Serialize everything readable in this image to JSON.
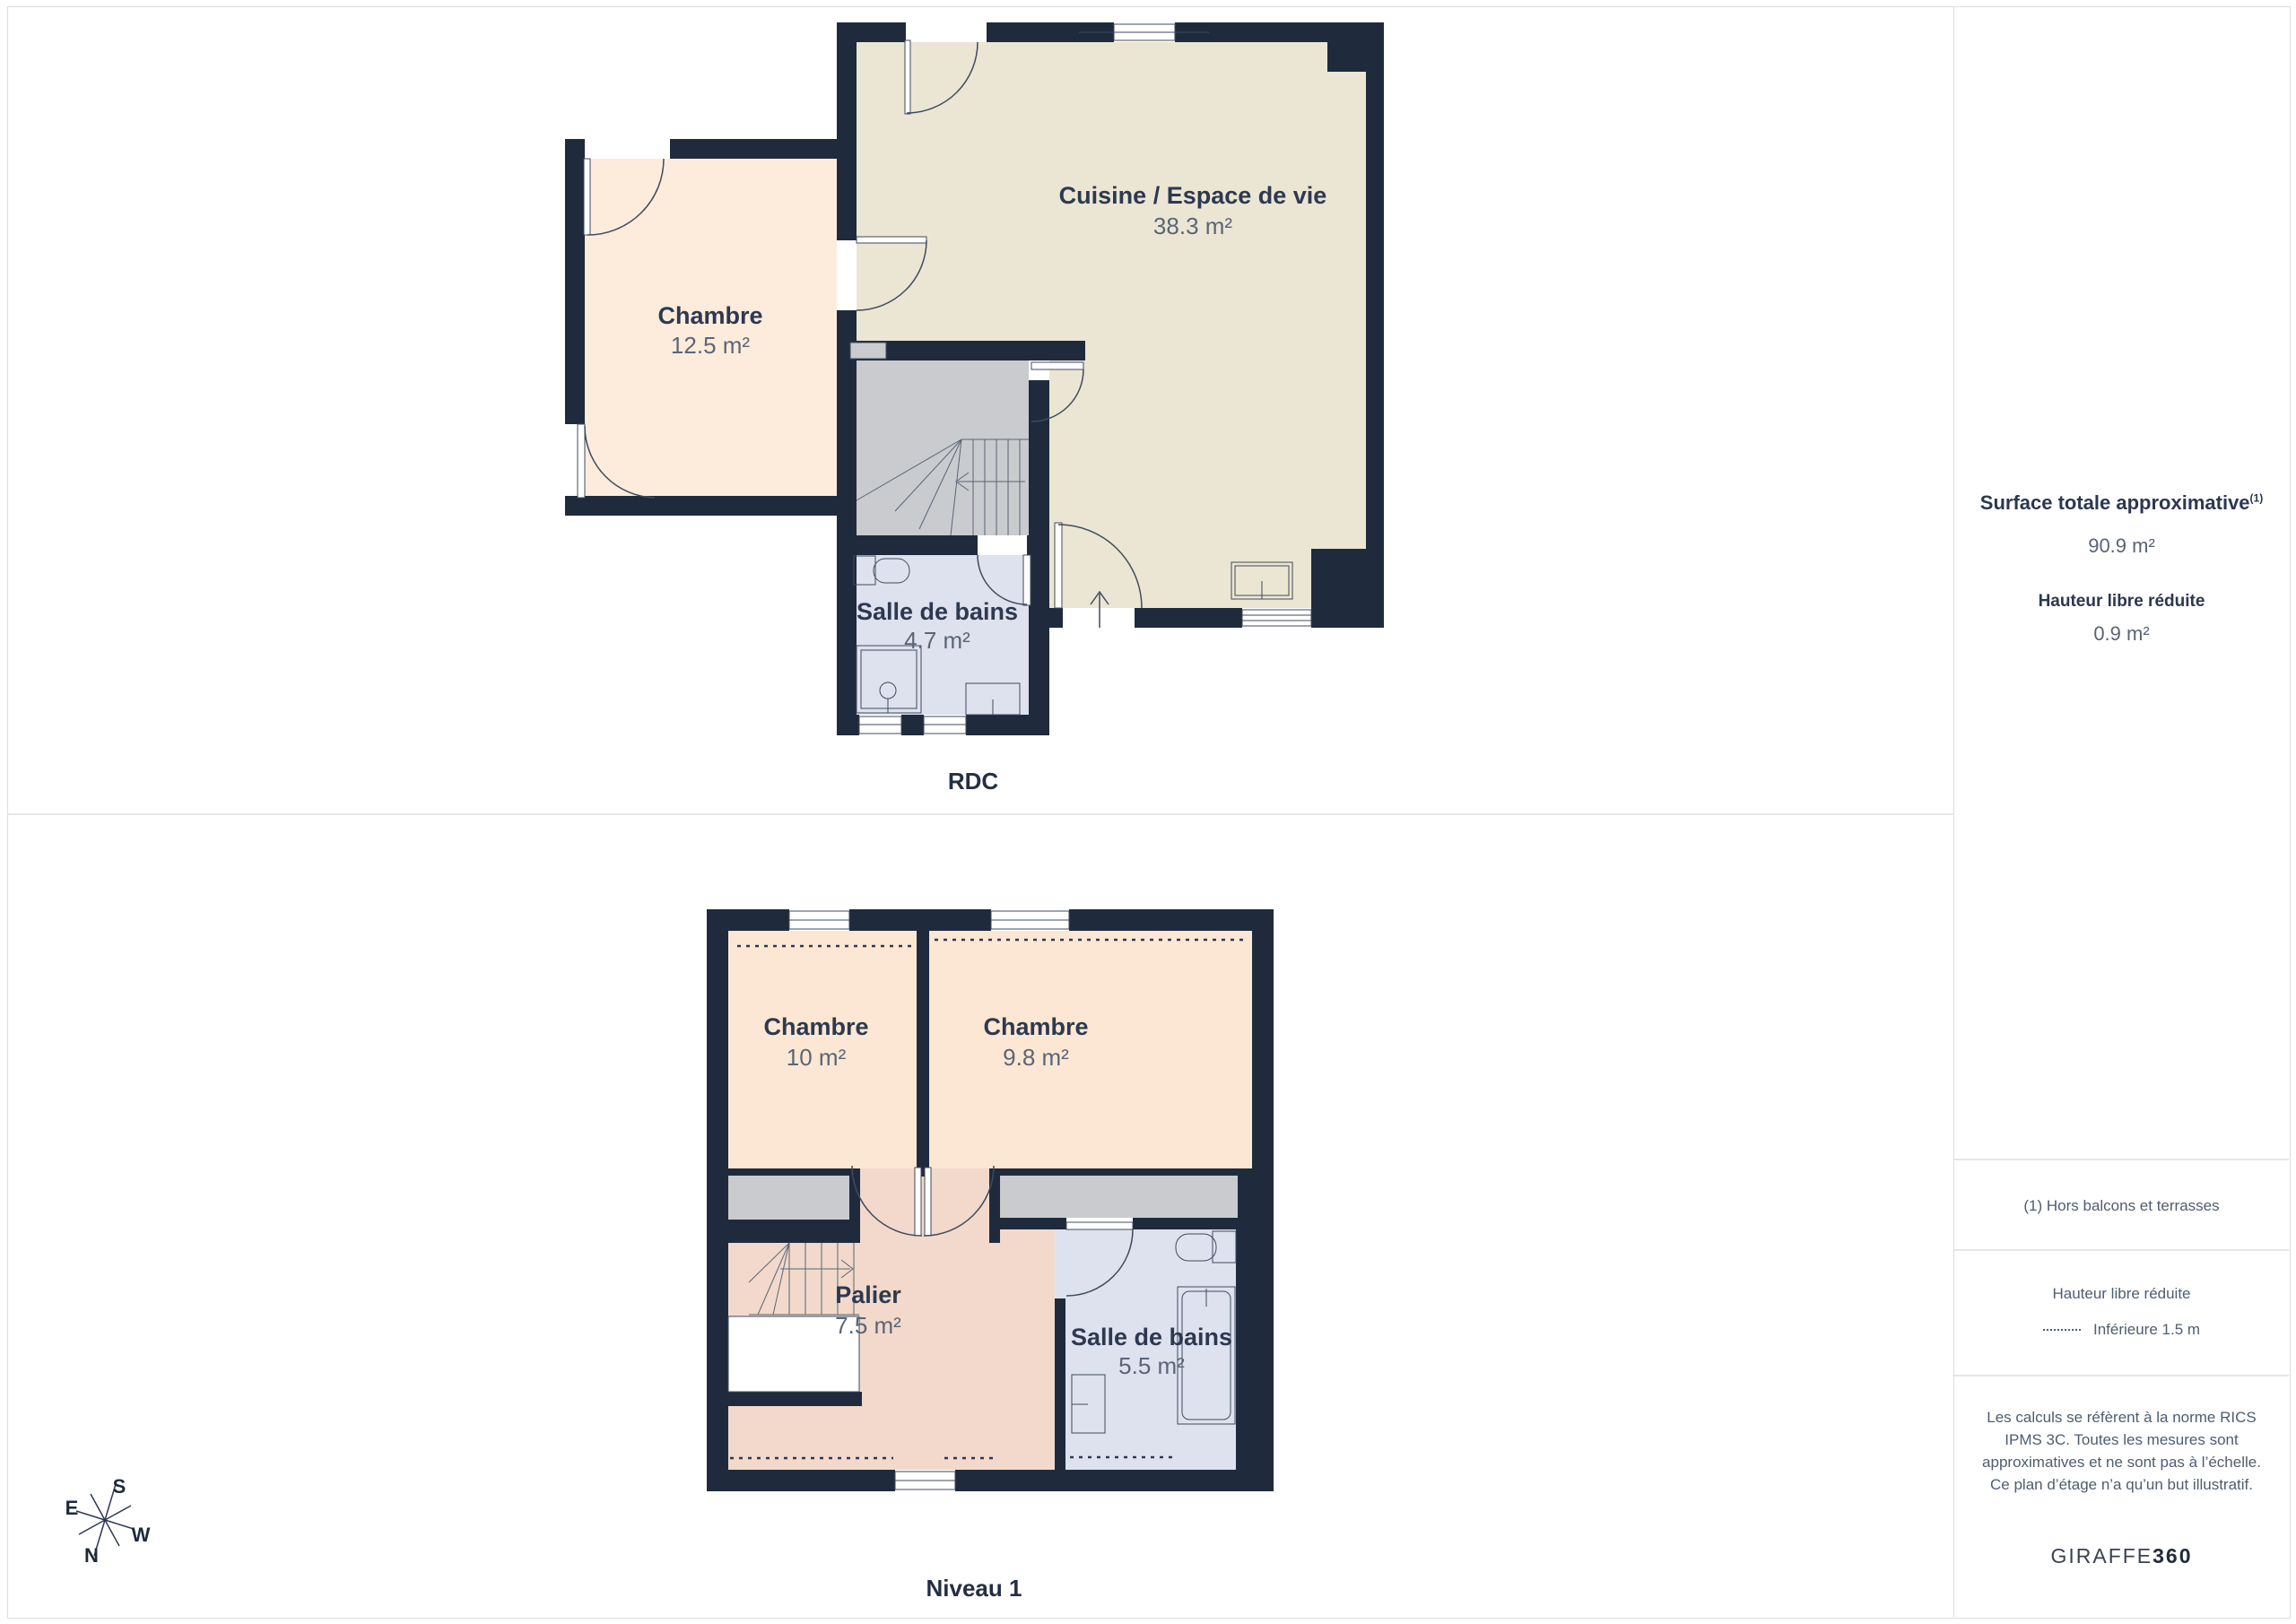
{
  "floors": [
    {
      "label": "RDC",
      "rooms": [
        {
          "name": "Chambre",
          "area": "12.5 m²"
        },
        {
          "name": "Cuisine / Espace de vie",
          "area": "38.3 m²"
        },
        {
          "name": "Salle de bains",
          "area": "4.7 m²"
        }
      ]
    },
    {
      "label": "Niveau 1",
      "rooms": [
        {
          "name": "Chambre",
          "area": "10 m²"
        },
        {
          "name": "Chambre",
          "area": "9.8 m²"
        },
        {
          "name": "Palier",
          "area": "7.5 m²"
        },
        {
          "name": "Salle de bains",
          "area": "5.5 m²"
        }
      ]
    }
  ],
  "compass": {
    "n": "N",
    "s": "S",
    "e": "E",
    "w": "W"
  },
  "sidebar": {
    "total_title": "Surface totale approximative",
    "total_superscript": "(1)",
    "total_value": "90.9 m²",
    "reduced_title": "Hauteur libre réduite",
    "reduced_value": "0.9 m²",
    "footnote": "(1) Hors balcons et terrasses",
    "legend_title": "Hauteur libre réduite",
    "legend_label": "Inférieure 1.5 m",
    "disclaimer": "Les calculs se réfèrent à la norme RICS IPMS 3C. Toutes les mesures sont approximatives et ne sont pas à l’échelle. Ce plan d’étage n’a qu’un but illustratif.",
    "brand_name": "GIRAFFE",
    "brand_suffix": "360"
  },
  "colors": {
    "wall": "#1f2b3c",
    "kitchen": "#ebe6d3",
    "bedroom_rdc": "#fdecdc",
    "bedroom_n1": "#fbe7d3",
    "bathroom": "#dee2ee",
    "landing": "#f2d9cb",
    "stairs": "#c9cbce",
    "divider": "#dedede"
  }
}
